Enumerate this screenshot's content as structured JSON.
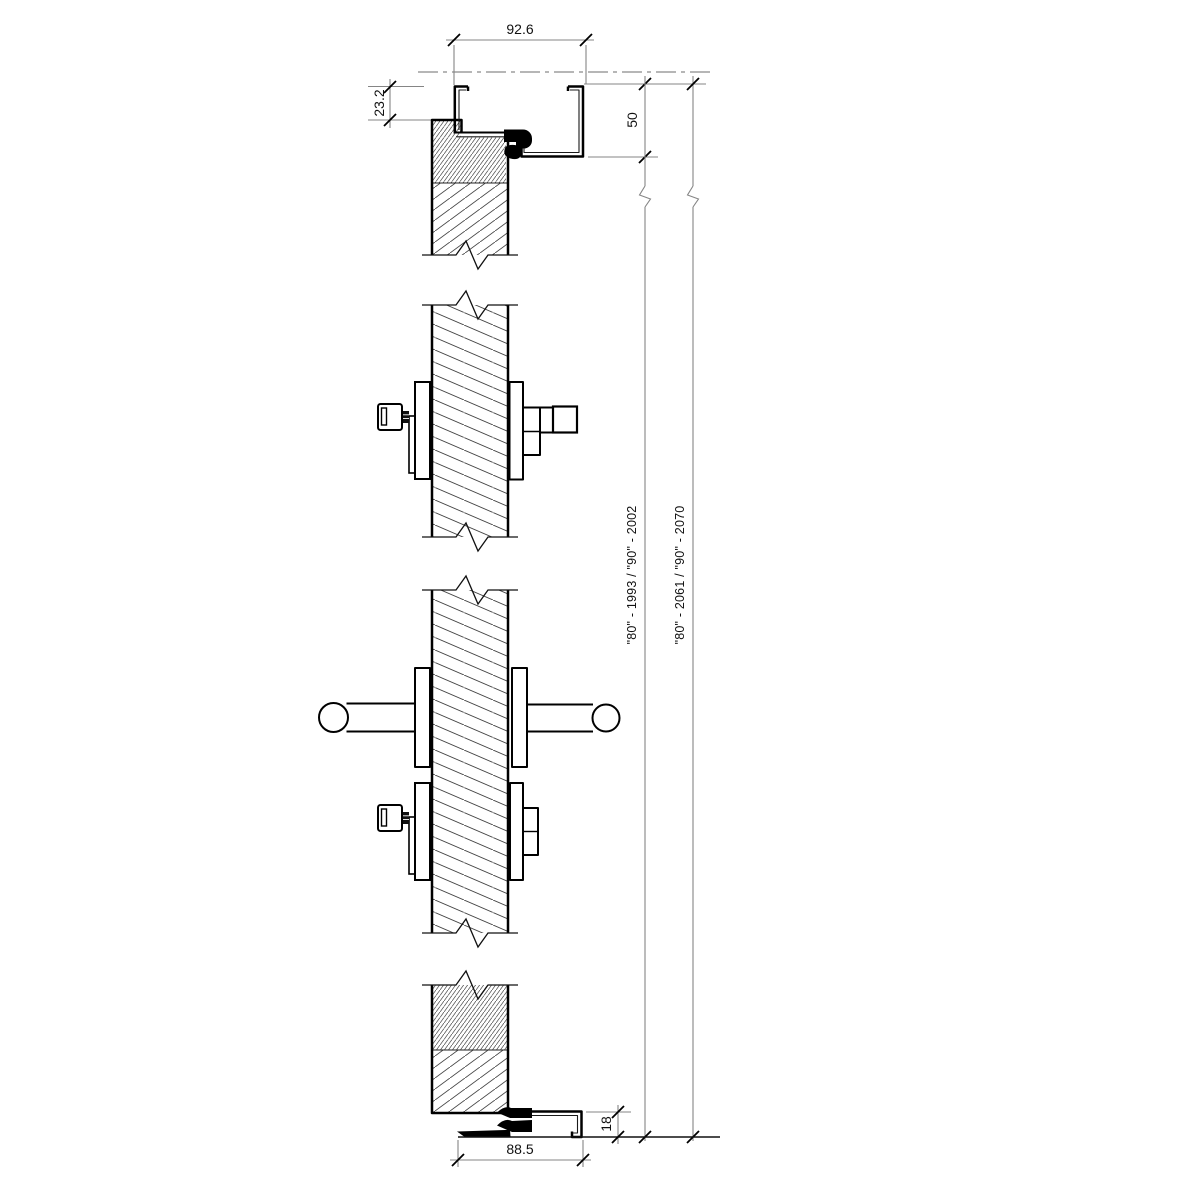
{
  "drawing": {
    "type": "door-vertical-section-detail",
    "colors": {
      "background": "#ffffff",
      "main_line": "#000000",
      "dimension_line": "#858585",
      "hatch_line": "#444444",
      "text": "#111111"
    },
    "dims": {
      "frame_head_width": "92.6",
      "frame_overlap": "23.2",
      "frame_head_height": "50",
      "door_height_label": "\"80\" - 1993 / \"90\" - 2002",
      "frame_total_height_label": "\"80\" - 2061 / \"90\" - 2070",
      "threshold_height": "18",
      "threshold_width": "88.5"
    }
  }
}
